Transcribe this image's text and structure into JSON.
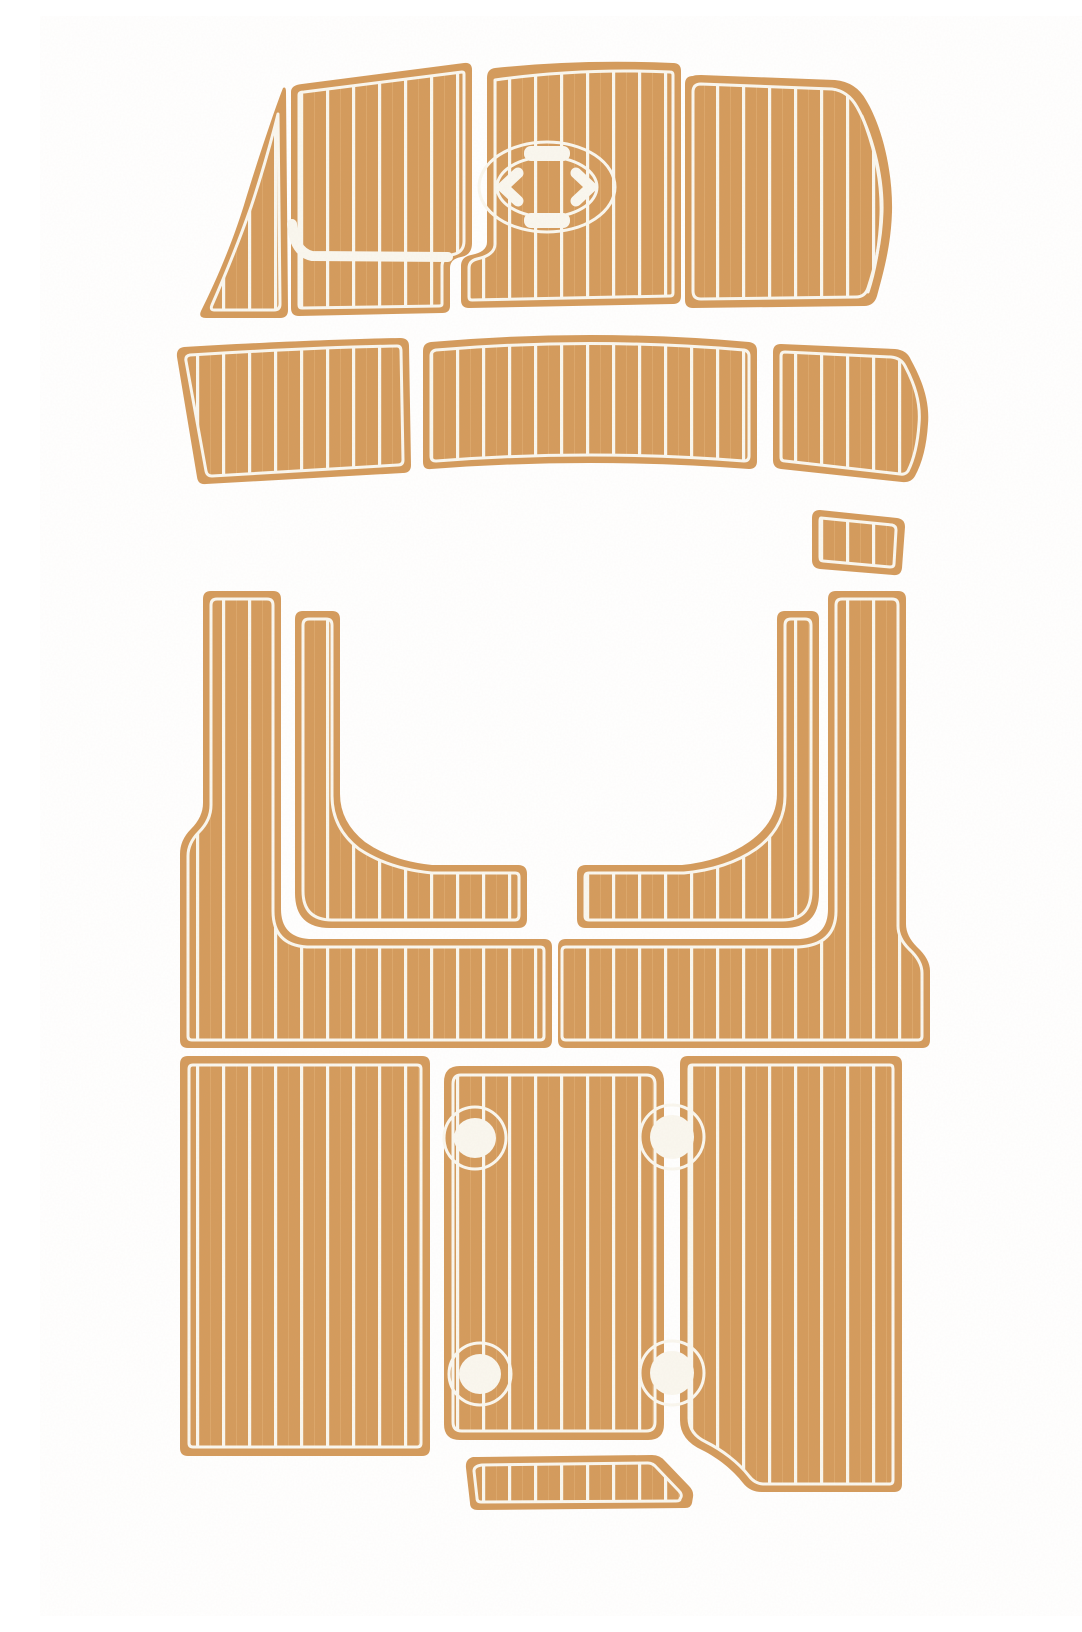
{
  "figure": {
    "title": "EVA foam faux teak boat decking pad kit, top view of 16 tan pads with white plank grooves on a white background"
  },
  "colors": {
    "pad": "#D49B5D",
    "line": "#FAF7EF",
    "background": "#FFFFFF"
  },
  "pattern": {
    "plank_spacing_px": 26,
    "plank_line_px": 3.2,
    "edge_margin_px": 8
  },
  "sections": {
    "bow": {
      "piece_count": 4,
      "pieces": [
        "port wedge pad",
        "port bow pad with routed L-groove",
        "center bow pad with oval hatch detail",
        "starboard bow pad with hull curve"
      ],
      "hatch_detail": "oval ring with inner ellipse, two grip bars and two chevron cutouts"
    },
    "walkway_arc": {
      "piece_count": 3,
      "pieces": [
        "port arc pad",
        "center arc pad",
        "starboard arc pad"
      ]
    },
    "cockpit": {
      "piece_count": 5,
      "pieces": [
        "helm step pad",
        "port runner with floor panel",
        "port inner L-pad",
        "starboard runner with floor panel",
        "starboard inner L-pad"
      ]
    },
    "swim_platform": {
      "piece_count": 4,
      "pieces": [
        "port panel",
        "center panel",
        "starboard panel with corner notch",
        "transom step pad"
      ],
      "circular_cutouts": 4
    }
  }
}
